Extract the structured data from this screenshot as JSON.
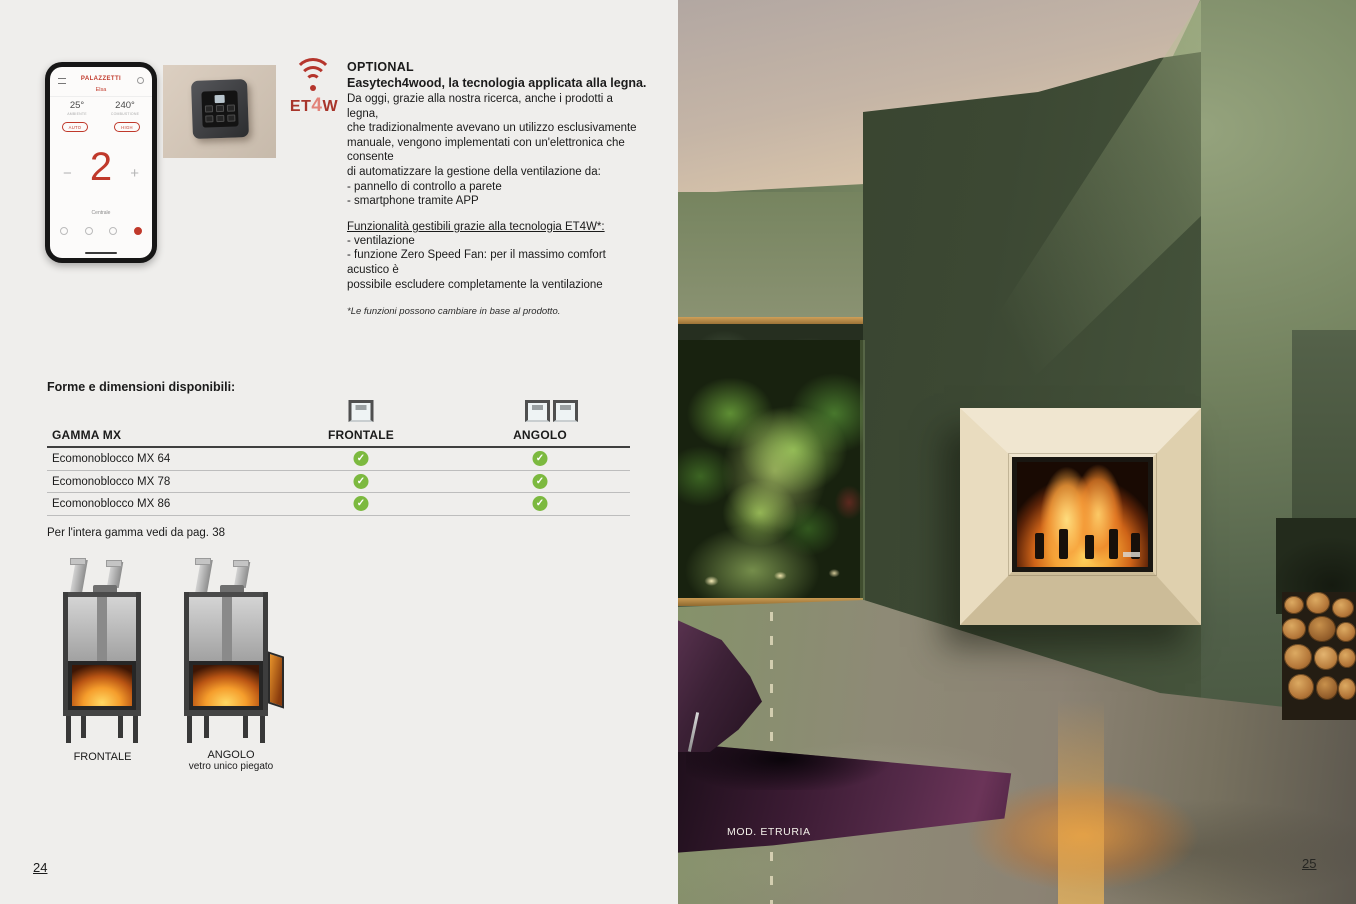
{
  "optional_section": {
    "kicker": "OPTIONAL",
    "title": "Easytech4wood, la tecnologia applicata alla legna.",
    "body": "Da oggi, grazie alla nostra ricerca, anche i prodotti a legna,\nche tradizionalmente avevano un utilizzo esclusivamente\nmanuale, vengono implementati con un'elettronica che consente\ndi automatizzare la gestione della ventilazione da:\n- pannello di controllo a parete\n- smartphone tramite APP",
    "functions_heading": "Funzionalità gestibili grazie alla tecnologia ET4W*:",
    "functions_body": "- ventilazione\n- funzione Zero Speed Fan: per il massimo comfort acustico è\npossibile escludere completamente la ventilazione",
    "footnote": "*Le funzioni possono cambiare in base al prodotto.",
    "et4w_logo": {
      "et": "ET",
      "four": "4",
      "w": "W"
    }
  },
  "phone_app": {
    "brand": "PALAZZETTI",
    "model": "Elsa",
    "temp_left": "25°",
    "temp_left_label": "AMBIENTE",
    "temp_right": "240°",
    "temp_right_label": "COMBUSTIONE",
    "mode_left": "AUTO",
    "mode_right": "HIGH",
    "power_value": "2",
    "minus": "−",
    "plus": "+",
    "bottom_label": "Centrale"
  },
  "availability": {
    "section_title": "Forme e dimensioni disponibili:",
    "col_model": "GAMMA MX",
    "col_frontale": "FRONTALE",
    "col_angolo": "ANGOLO",
    "check_glyph": "✓",
    "rows": [
      {
        "name": "Ecomonoblocco MX 64",
        "frontale": true,
        "angolo": true
      },
      {
        "name": "Ecomonoblocco MX 78",
        "frontale": true,
        "angolo": true
      },
      {
        "name": "Ecomonoblocco MX 86",
        "frontale": true,
        "angolo": true
      }
    ],
    "footer_note": "Per l'intera gamma vedi da pag. 38"
  },
  "products": {
    "frontale_caption": "FRONTALE",
    "angolo_caption": "ANGOLO",
    "angolo_subcaption": "vetro unico piegato"
  },
  "photo": {
    "caption": "MOD. ETRURIA"
  },
  "page_numbers": {
    "left": "24",
    "right": "25"
  },
  "colors": {
    "accent_red": "#b5352c",
    "check_green": "#7cb93f",
    "page_background": "#efeeec",
    "wall_green_dark": "#3c4833",
    "wall_green_light": "#8e9b77",
    "travertine": "#e7dbc2",
    "rug_purple": "#4a2140"
  }
}
